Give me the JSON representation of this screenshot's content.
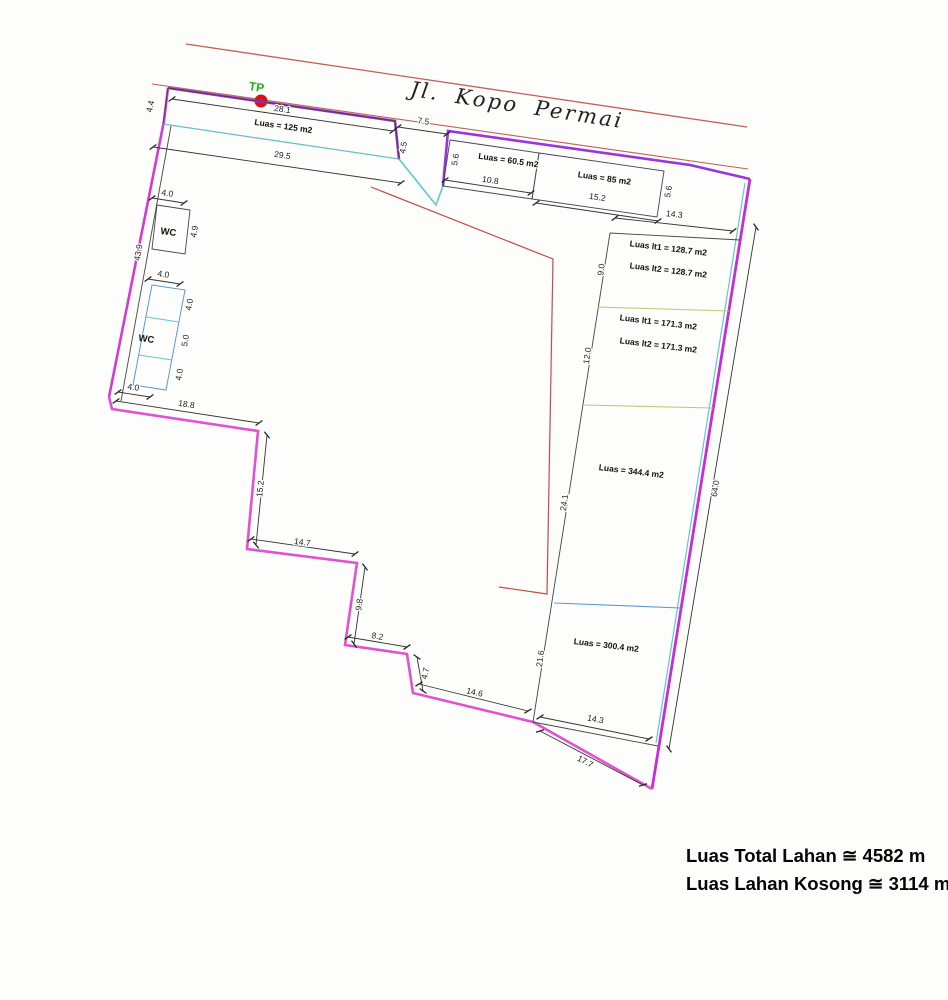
{
  "street": {
    "name": "Jl. Kopo Permai"
  },
  "tp": {
    "label": "TP"
  },
  "areas": {
    "strip1": "Luas = 125 m2",
    "strip2": "Luas = 60.5 m2",
    "strip3": "Luas = 85 m2",
    "blockA1": "Luas lt1 = 128.7 m2",
    "blockA2": "Luas lt2 = 128.7 m2",
    "blockB1": "Luas lt1 = 171.3 m2",
    "blockB2": "Luas lt2 = 171.3 m2",
    "blockC": "Luas = 344.4 m2",
    "blockD": "Luas = 300.4 m2"
  },
  "rooms": {
    "wc1": "WC",
    "wc2": "WC"
  },
  "dims": {
    "d4_4": "4.4",
    "d28_1": "28.1",
    "d29_5": "29.5",
    "d7_5": "7.5",
    "d4_5": "4.5",
    "d5_6a": "5.6",
    "d10_8": "10.8",
    "d15_2a": "15.2",
    "d5_6b": "5.6",
    "d14_3a": "14.3",
    "d9_0": "9.0",
    "d12_0": "12.0",
    "d24_1": "24.1",
    "d21_6": "21.6",
    "d64_0": "64.0",
    "d14_3b": "14.3",
    "d17_7": "17.7",
    "d4_0a": "4.0",
    "d4_9": "4.9",
    "d43_9": "43.9",
    "d4_0b": "4.0",
    "d4_0c": "4.0",
    "d5_0": "5.0",
    "d4_0d": "4.0",
    "d4_0e": "4.0",
    "d18_8": "18.8",
    "d15_2b": "15.2",
    "d14_7": "14.7",
    "d9_8": "9.8",
    "d8_2": "8.2",
    "d4_7": "4.7",
    "d14_6": "14.6"
  },
  "summary": {
    "line1": "Luas Total Lahan ≅ 4582 m",
    "line2": "Luas Lahan Kosong ≅ 3114 m"
  },
  "colors": {
    "boundary_purple": "#9a35d8",
    "boundary_magenta": "#e052cf",
    "boundary_right": "#c42ed8",
    "street_red": "#c0605a",
    "inner_red": "#c34b4b",
    "cyan": "#5fc8cf",
    "olive": "#c9c56a",
    "blue": "#5b9bd1",
    "tp_dot": "#dd1111",
    "tp_text": "#19b219"
  }
}
